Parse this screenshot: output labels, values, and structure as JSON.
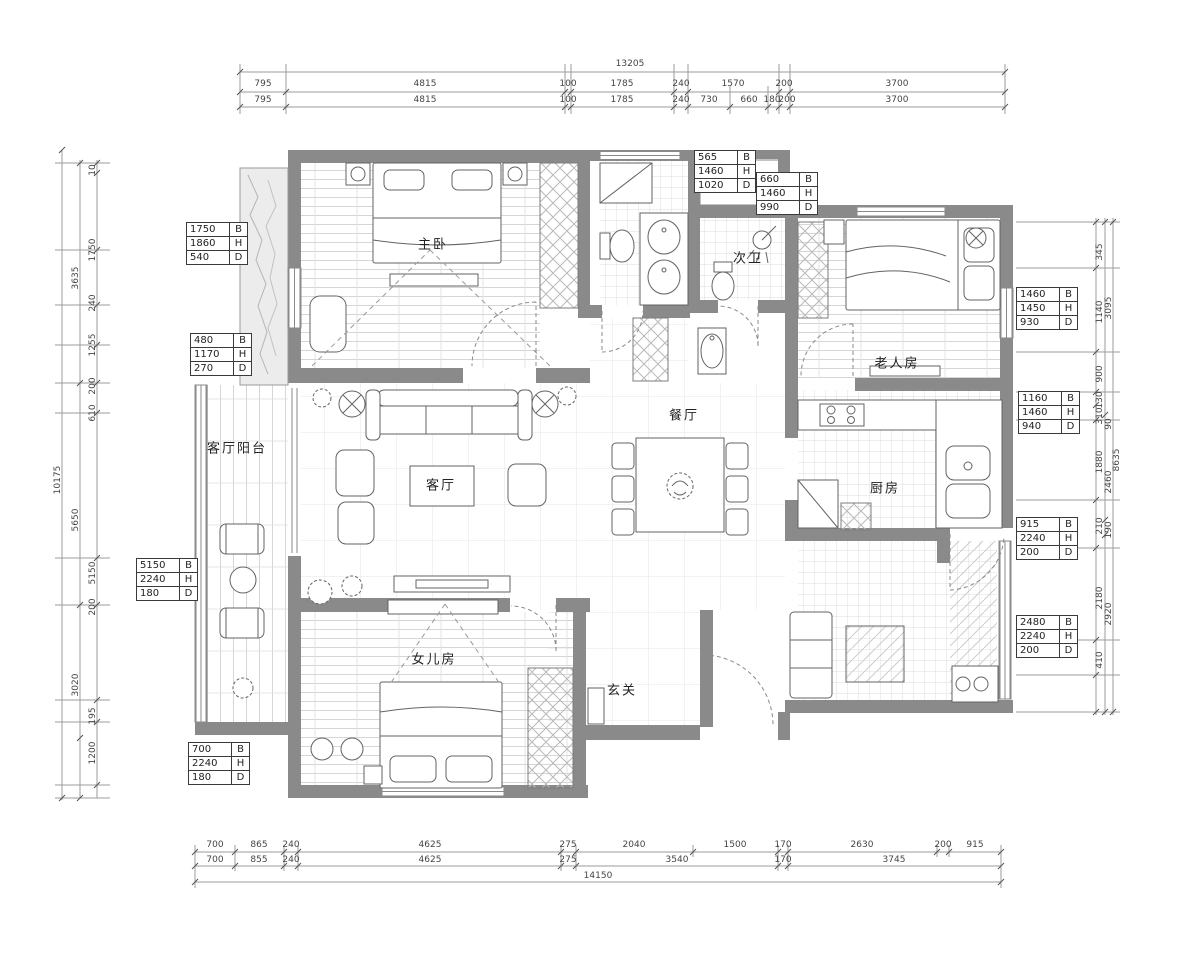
{
  "rooms": {
    "master": "主卧",
    "second_bath": "次卫",
    "elder": "老人房",
    "dining": "餐厅",
    "living": "客厅",
    "kitchen": "厨房",
    "living_balcony": "客厅阳台",
    "daughter": "女儿房",
    "foyer": "玄关"
  },
  "dims": {
    "top": {
      "total": "13205",
      "row1": [
        "795",
        "4815",
        "100",
        "1785",
        "240",
        "1570",
        "200",
        "3700"
      ],
      "row2": [
        "795",
        "4815",
        "100",
        "1785",
        "240",
        "730",
        "660",
        "180",
        "200",
        "3700"
      ]
    },
    "bottom": {
      "row1": [
        "700",
        "865",
        "240",
        "4625",
        "275",
        "2040",
        "1500",
        "170",
        "2630",
        "200",
        "915"
      ],
      "row2": [
        "700",
        "855",
        "240",
        "4625",
        "275",
        "3540",
        "170",
        "3745"
      ],
      "total": "14150"
    },
    "left": {
      "outer": "10175",
      "middle": [
        "3635",
        "5650",
        "3020"
      ],
      "inner": [
        "10",
        "1750",
        "240",
        "1255",
        "200",
        "610",
        "5150",
        "200",
        "195",
        "1200"
      ]
    },
    "right": {
      "outer": "8635",
      "middle": [
        "3095",
        "90",
        "2460",
        "190",
        "2920"
      ],
      "inner": [
        "345",
        "1140",
        "900",
        "130",
        "310",
        "1880",
        "210",
        "2180",
        "410"
      ]
    }
  },
  "spec_boxes": [
    {
      "rows": [
        [
          "1750",
          "B"
        ],
        [
          "1860",
          "H"
        ],
        [
          "540",
          "D"
        ]
      ]
    },
    {
      "rows": [
        [
          "480",
          "B"
        ],
        [
          "1170",
          "H"
        ],
        [
          "270",
          "D"
        ]
      ]
    },
    {
      "rows": [
        [
          "5150",
          "B"
        ],
        [
          "2240",
          "H"
        ],
        [
          "180",
          "D"
        ]
      ]
    },
    {
      "rows": [
        [
          "700",
          "B"
        ],
        [
          "2240",
          "H"
        ],
        [
          "180",
          "D"
        ]
      ]
    },
    {
      "rows": [
        [
          "565",
          "B"
        ],
        [
          "1460",
          "H"
        ],
        [
          "1020",
          "D"
        ]
      ]
    },
    {
      "rows": [
        [
          "660",
          "B"
        ],
        [
          "1460",
          "H"
        ],
        [
          "990",
          "D"
        ]
      ]
    },
    {
      "rows": [
        [
          "1460",
          "B"
        ],
        [
          "1450",
          "H"
        ],
        [
          "930",
          "D"
        ]
      ]
    },
    {
      "rows": [
        [
          "1160",
          "B"
        ],
        [
          "1460",
          "H"
        ],
        [
          "940",
          "D"
        ]
      ]
    },
    {
      "rows": [
        [
          "915",
          "B"
        ],
        [
          "2240",
          "H"
        ],
        [
          "200",
          "D"
        ]
      ]
    },
    {
      "rows": [
        [
          "2480",
          "B"
        ],
        [
          "2240",
          "H"
        ],
        [
          "200",
          "D"
        ]
      ]
    }
  ]
}
